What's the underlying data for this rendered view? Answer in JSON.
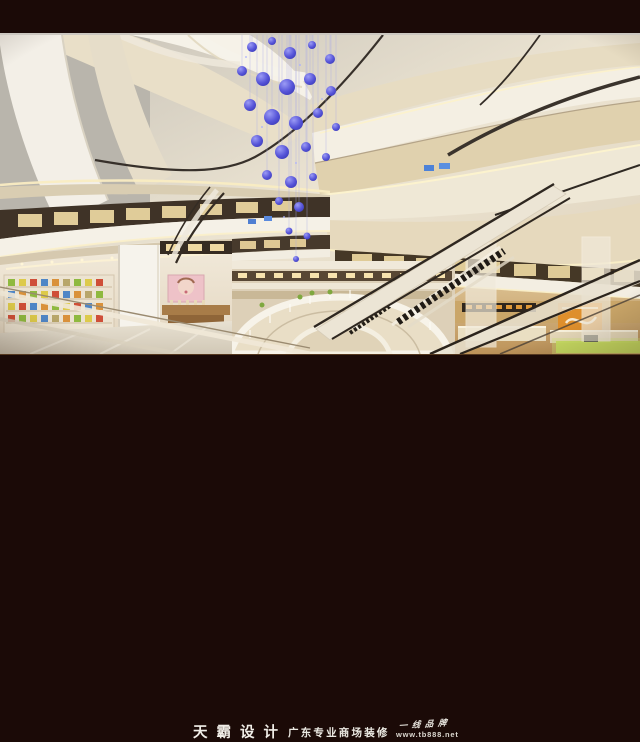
{
  "image": {
    "alt": "Rendering of a multi-level shopping mall atrium with wavy cream ceiling bands, a blue crystal chandelier, crossing escalators, balconies and shops"
  },
  "caption": {
    "brand": "天霸设计",
    "tagline": "广东专业商场装修",
    "slogan": "一线品牌",
    "website": "www.tb888.net"
  },
  "colors": {
    "frame": "#1b0a07",
    "ceiling_white": "#f5f1e8",
    "ceiling_cream": "#e3d5b6",
    "warm_glow": "#fbf0ca",
    "storefront_dark": "#42362a",
    "shop_warm": "#caa669",
    "chandelier_blue": "#4a49cf",
    "accent_orange": "#de8f2c",
    "accent_green": "#c8de62",
    "caption_text": "#f1eee8"
  }
}
